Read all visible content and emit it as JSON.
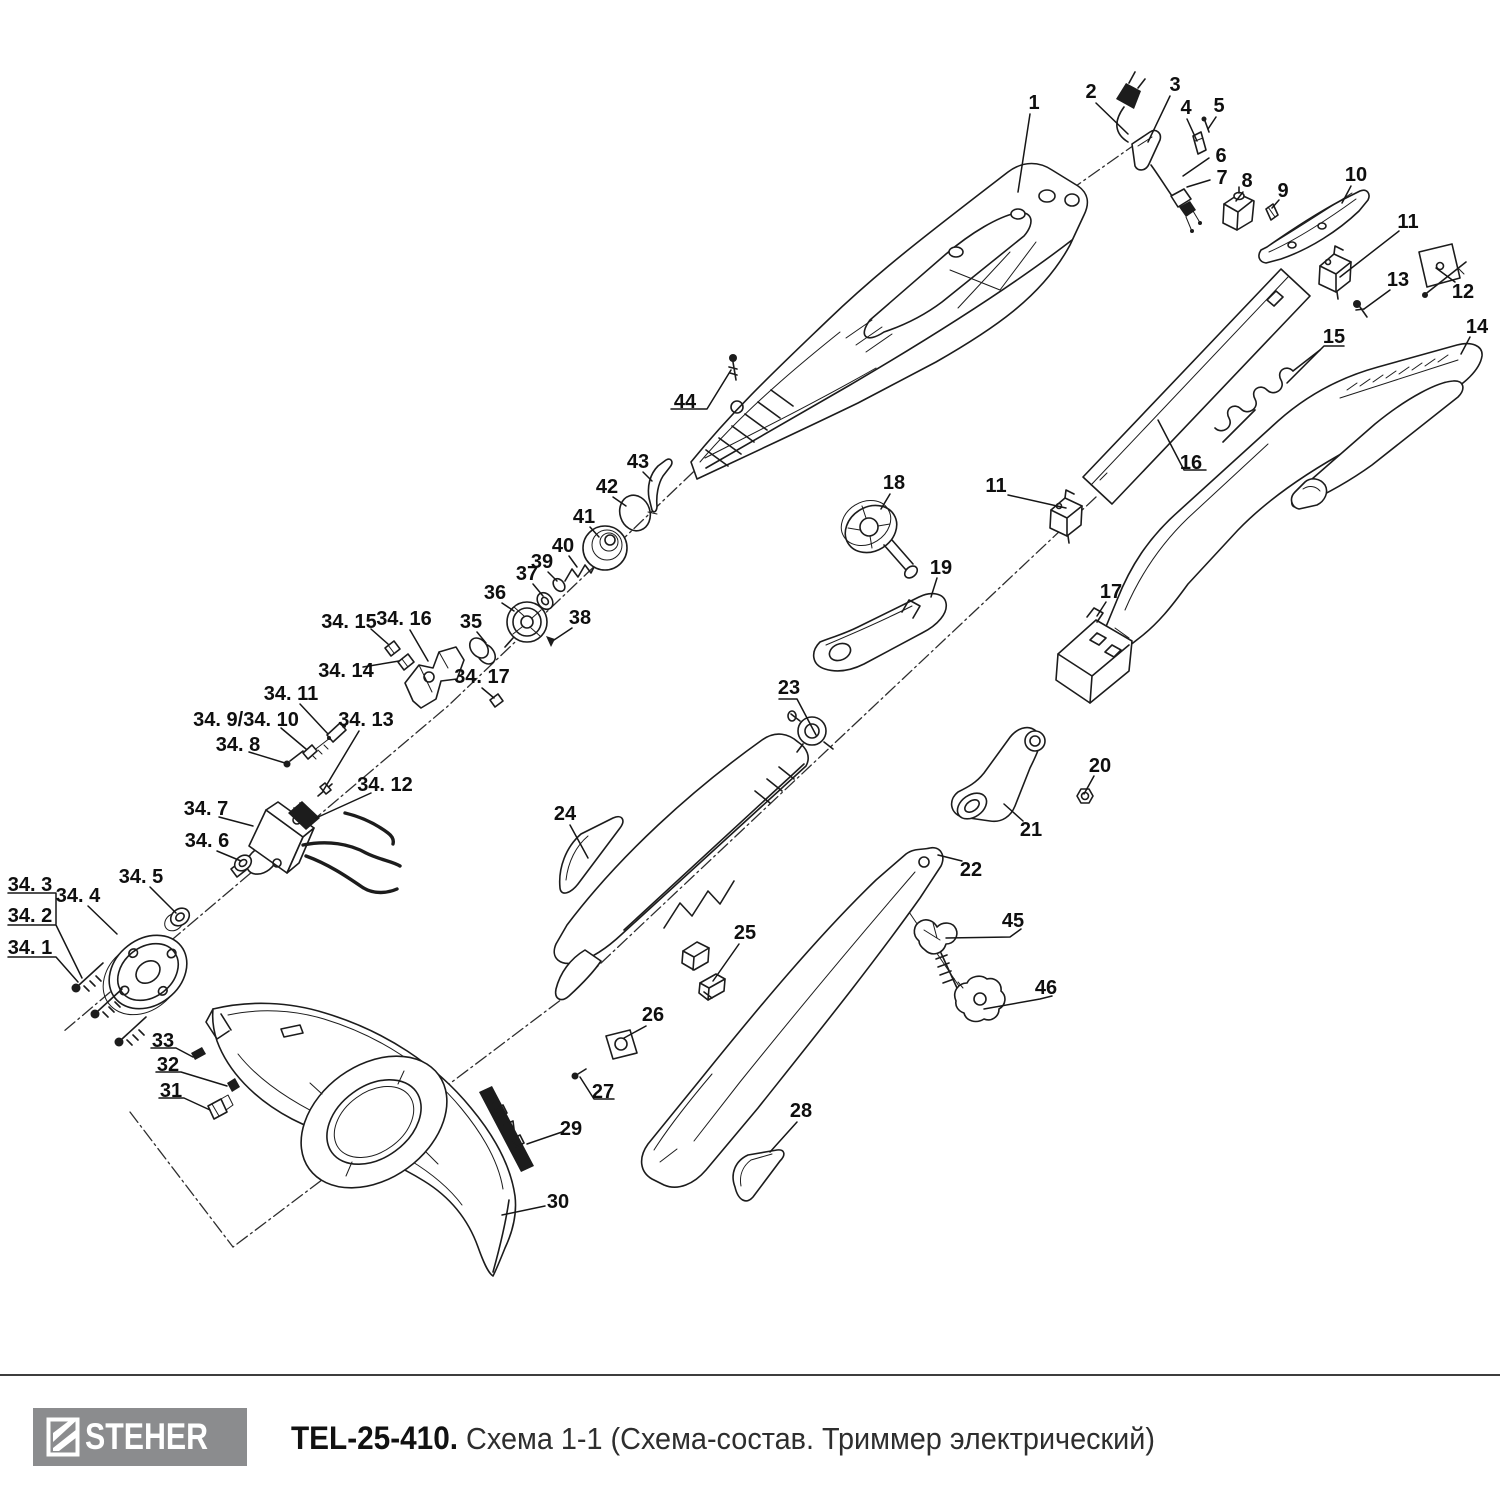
{
  "footer": {
    "brand_text": "STEHER",
    "title_bold": "TEL-25-410.",
    "title_regular": " Схема 1-1 (Схема-состав. Триммер электрический)",
    "logo_bg": "#8b8c8e",
    "divider_color": "#3d3d3d"
  },
  "diagram": {
    "line_color": "#1c1c1c",
    "background": "#ffffff",
    "callouts": [
      {
        "label": "1",
        "x": 1034,
        "y": 102,
        "leader": [
          1030,
          114,
          1018,
          192
        ]
      },
      {
        "label": "2",
        "x": 1091,
        "y": 91,
        "leader": [
          1096,
          103,
          1128,
          134
        ]
      },
      {
        "label": "3",
        "x": 1175,
        "y": 84,
        "leader": [
          1170,
          96,
          1148,
          142
        ]
      },
      {
        "label": "4",
        "x": 1186,
        "y": 107,
        "leader": [
          1187,
          119,
          1197,
          141
        ]
      },
      {
        "label": "5",
        "x": 1219,
        "y": 105,
        "leader": [
          1216,
          117,
          1208,
          129
        ]
      },
      {
        "label": "6",
        "x": 1221,
        "y": 155,
        "leader": [
          1209,
          158,
          1183,
          176
        ]
      },
      {
        "label": "7",
        "x": 1222,
        "y": 177,
        "leader": [
          1210,
          180,
          1187,
          187
        ]
      },
      {
        "label": "8",
        "x": 1247,
        "y": 180,
        "leader": [
          1243,
          192,
          1236,
          201
        ]
      },
      {
        "label": "9",
        "x": 1283,
        "y": 190,
        "leader": [
          1279,
          200,
          1272,
          208
        ]
      },
      {
        "label": "10",
        "x": 1356,
        "y": 174,
        "leader": [
          1351,
          186,
          1342,
          203
        ]
      },
      {
        "label": "11",
        "x": 1408,
        "y": 221,
        "leader": [
          1399,
          231,
          1340,
          277
        ]
      },
      {
        "label": "11",
        "x": 996,
        "y": 485,
        "leader": [
          1008,
          495,
          1066,
          508
        ]
      },
      {
        "label": "12",
        "x": 1463,
        "y": 291,
        "leader": [
          1455,
          282,
          1436,
          268
        ]
      },
      {
        "label": "13",
        "x": 1398,
        "y": 279,
        "leader": [
          1390,
          290,
          1364,
          309
        ]
      },
      {
        "label": "14",
        "x": 1477,
        "y": 326,
        "leader": [
          1470,
          337,
          1461,
          354
        ]
      },
      {
        "label": "15",
        "x": 1334,
        "y": 336,
        "leader": [
          1344,
          346,
          1324,
          346,
          1287,
          383
        ]
      },
      {
        "label": "16",
        "x": 1191,
        "y": 462,
        "leader": [
          1206,
          470,
          1184,
          470,
          1158,
          420
        ]
      },
      {
        "label": "17",
        "x": 1111,
        "y": 591,
        "leader": [
          1106,
          602,
          1097,
          616
        ]
      },
      {
        "label": "18",
        "x": 894,
        "y": 482,
        "leader": [
          890,
          494,
          881,
          509
        ]
      },
      {
        "label": "19",
        "x": 941,
        "y": 567,
        "leader": [
          937,
          578,
          931,
          597
        ]
      },
      {
        "label": "20",
        "x": 1100,
        "y": 765,
        "leader": [
          1094,
          776,
          1084,
          794
        ]
      },
      {
        "label": "21",
        "x": 1031,
        "y": 829,
        "leader": [
          1023,
          821,
          1004,
          804
        ]
      },
      {
        "label": "22",
        "x": 971,
        "y": 869,
        "leader": [
          962,
          861,
          938,
          855
        ]
      },
      {
        "label": "23",
        "x": 789,
        "y": 687,
        "leader": [
          779,
          699,
          797,
          699,
          816,
          735
        ]
      },
      {
        "label": "24",
        "x": 565,
        "y": 813,
        "leader": [
          570,
          825,
          588,
          858
        ]
      },
      {
        "label": "25",
        "x": 745,
        "y": 932,
        "leader": [
          739,
          944,
          713,
          981
        ]
      },
      {
        "label": "26",
        "x": 653,
        "y": 1014,
        "leader": [
          646,
          1026,
          624,
          1038
        ]
      },
      {
        "label": "27",
        "x": 603,
        "y": 1091,
        "leader": [
          614,
          1099,
          594,
          1099,
          580,
          1077
        ]
      },
      {
        "label": "28",
        "x": 801,
        "y": 1110,
        "leader": [
          797,
          1122,
          770,
          1152
        ]
      },
      {
        "label": "29",
        "x": 571,
        "y": 1128,
        "leader": [
          562,
          1132,
          527,
          1144
        ]
      },
      {
        "label": "30",
        "x": 558,
        "y": 1201,
        "leader": [
          545,
          1206,
          502,
          1215
        ]
      },
      {
        "label": "31",
        "x": 171,
        "y": 1090,
        "leader": [
          159,
          1098,
          184,
          1098,
          210,
          1110
        ]
      },
      {
        "label": "32",
        "x": 168,
        "y": 1064,
        "leader": [
          156,
          1072,
          181,
          1072,
          227,
          1086
        ]
      },
      {
        "label": "33",
        "x": 163,
        "y": 1040,
        "leader": [
          151,
          1048,
          176,
          1048,
          193,
          1057
        ]
      },
      {
        "label": "34. 1",
        "x": 30,
        "y": 947,
        "leader": [
          8,
          957,
          56,
          957,
          78,
          982
        ]
      },
      {
        "label": "34. 2",
        "x": 30,
        "y": 915,
        "leader": [
          8,
          925,
          56,
          925,
          82,
          978
        ]
      },
      {
        "label": "34. 3",
        "x": 30,
        "y": 884,
        "leader": [
          8,
          893,
          56,
          893,
          56,
          924
        ]
      },
      {
        "label": "34. 4",
        "x": 78,
        "y": 895,
        "leader": [
          88,
          906,
          117,
          934
        ]
      },
      {
        "label": "34. 5",
        "x": 141,
        "y": 876,
        "leader": [
          150,
          887,
          176,
          913
        ]
      },
      {
        "label": "34. 6",
        "x": 207,
        "y": 840,
        "leader": [
          217,
          851,
          241,
          861
        ]
      },
      {
        "label": "34. 7",
        "x": 206,
        "y": 808,
        "leader": [
          219,
          817,
          253,
          826
        ]
      },
      {
        "label": "34. 8",
        "x": 238,
        "y": 744,
        "leader": [
          249,
          752,
          285,
          763
        ]
      },
      {
        "label": "34. 9/34. 10",
        "x": 246,
        "y": 719,
        "leader": [
          281,
          728,
          306,
          749
        ]
      },
      {
        "label": "34. 11",
        "x": 291,
        "y": 693,
        "leader": [
          300,
          704,
          328,
          734
        ]
      },
      {
        "label": "34. 12",
        "x": 385,
        "y": 784,
        "leader": [
          371,
          793,
          316,
          818
        ]
      },
      {
        "label": "34. 13",
        "x": 366,
        "y": 719,
        "leader": [
          359,
          731,
          323,
          791
        ]
      },
      {
        "label": "34. 14",
        "x": 346,
        "y": 670,
        "leader": [
          363,
          667,
          399,
          661
        ]
      },
      {
        "label": "34. 15",
        "x": 349,
        "y": 621,
        "leader": [
          371,
          629,
          388,
          644
        ]
      },
      {
        "label": "34. 16",
        "x": 404,
        "y": 618,
        "leader": [
          410,
          630,
          428,
          661
        ]
      },
      {
        "label": "34. 17",
        "x": 482,
        "y": 676,
        "leader": [
          482,
          688,
          494,
          698
        ]
      },
      {
        "label": "35",
        "x": 471,
        "y": 621,
        "leader": [
          477,
          632,
          486,
          643
        ]
      },
      {
        "label": "36",
        "x": 495,
        "y": 592,
        "leader": [
          502,
          603,
          514,
          611
        ]
      },
      {
        "label": "37",
        "x": 527,
        "y": 573,
        "leader": [
          533,
          584,
          543,
          596
        ]
      },
      {
        "label": "38",
        "x": 580,
        "y": 617,
        "leader": [
          572,
          628,
          554,
          640
        ]
      },
      {
        "label": "39",
        "x": 542,
        "y": 561,
        "leader": [
          548,
          572,
          557,
          581
        ]
      },
      {
        "label": "40",
        "x": 563,
        "y": 545,
        "leader": [
          569,
          556,
          577,
          567
        ]
      },
      {
        "label": "41",
        "x": 584,
        "y": 516,
        "leader": [
          590,
          527,
          599,
          537
        ]
      },
      {
        "label": "42",
        "x": 607,
        "y": 486,
        "leader": [
          613,
          497,
          626,
          506
        ]
      },
      {
        "label": "43",
        "x": 638,
        "y": 461,
        "leader": [
          643,
          472,
          652,
          481
        ]
      },
      {
        "label": "44",
        "x": 685,
        "y": 401,
        "leader": [
          671,
          409,
          707,
          409,
          731,
          370
        ]
      },
      {
        "label": "45",
        "x": 1013,
        "y": 920,
        "leader": [
          1021,
          929,
          1010,
          937,
          946,
          938
        ]
      },
      {
        "label": "46",
        "x": 1046,
        "y": 987,
        "leader": [
          1052,
          996,
          1040,
          999,
          984,
          1009
        ]
      }
    ]
  }
}
